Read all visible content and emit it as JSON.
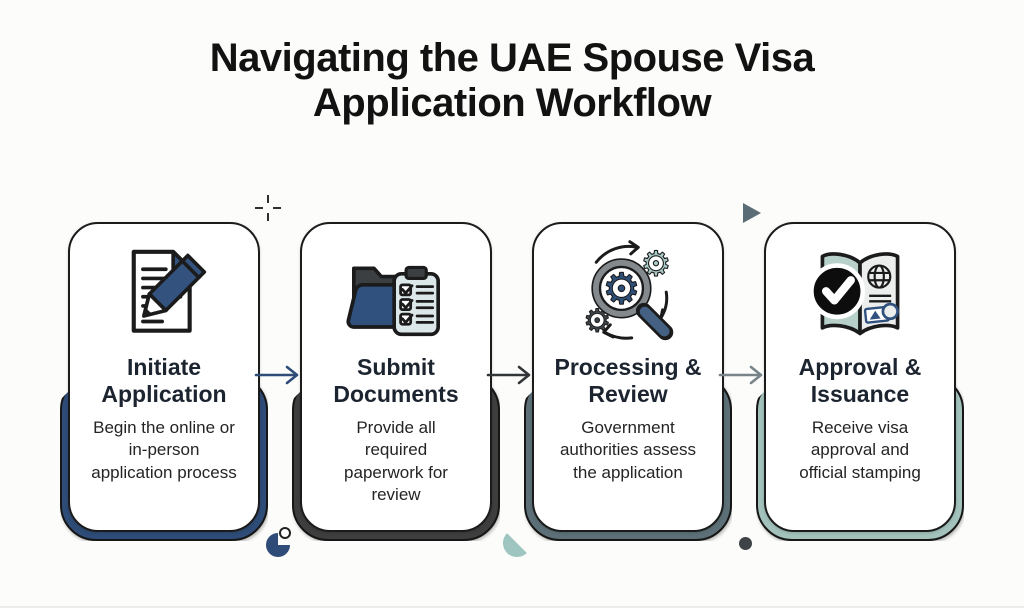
{
  "title": "Navigating the UAE Spouse Visa Application Workflow",
  "steps": [
    {
      "title": "Initiate Application",
      "description": "Begin the online or in-person application process",
      "accent": "#2e4c77",
      "icon": "document-pen-icon"
    },
    {
      "title": "Submit Documents",
      "description": "Provide all required paperwork for review",
      "accent": "#3e3e3e",
      "icon": "folder-clipboard-icon"
    },
    {
      "title": "Processing & Review",
      "description": "Government authorities assess the application",
      "accent": "#5d7078",
      "icon": "magnifier-gears-icon"
    },
    {
      "title": "Approval & Issuance",
      "description": "Receive visa approval and official stamping",
      "accent": "#a2c2bb",
      "icon": "passport-check-icon"
    }
  ],
  "arrows": [
    {
      "color": "#2e4c77"
    },
    {
      "color": "#333638"
    },
    {
      "color": "#76848a"
    }
  ],
  "decorations": {
    "crosshair_color": "#2f2f2f",
    "triangle_color": "#5a6d77",
    "quarter_circle_color": "#2e4c77",
    "droplet_color": "#9fc5c0",
    "dot_color": "#3e4347"
  }
}
